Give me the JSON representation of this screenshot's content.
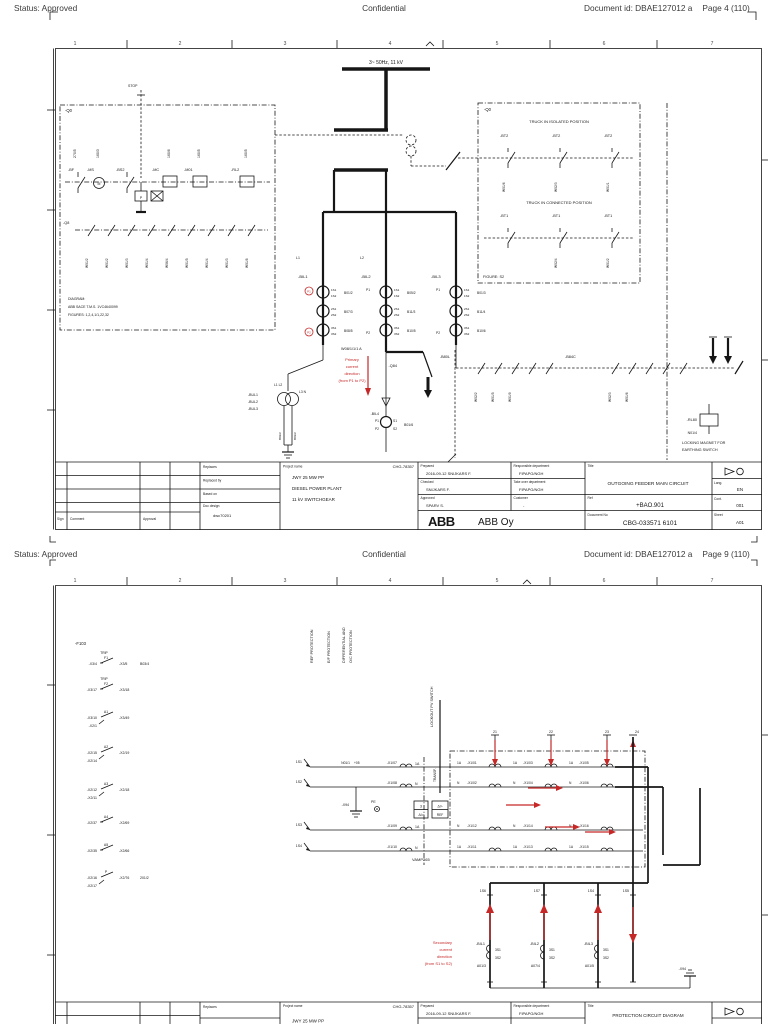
{
  "page1": {
    "header": {
      "status": "Status: Approved",
      "confidential": "Confidential",
      "doc_id": "Document id: DBAE127012 a",
      "page": "Page 4 (110)"
    },
    "ruler": [
      "1",
      "2",
      "3",
      "4",
      "5",
      "6",
      "7"
    ],
    "sch": {
      "stop": "STOP",
      "busbar": "3~ 50Hz,  11 kV",
      "q0l": "-Q0",
      "q0r": "-Q0",
      "wirecols": [
        "270/5",
        "160/3",
        "160/6",
        "160/5",
        "160/5"
      ],
      "bf": "-BF",
      "ms": "-MS",
      "m": "M",
      "bs2": "-BS2",
      "mc": "-MC",
      "m01": "-M01",
      "rl2": "-RL2",
      "p": "P",
      "q8": "-Q8",
      "q8w": [
        "W01/2",
        "W01/2",
        "W01/3",
        "W01/4",
        "W06/4",
        "W01/5",
        "W01/4",
        "W01/3",
        "W01/8"
      ],
      "note1": "DIAGRAM:",
      "note2": "ABB SACE T.M.S. 1VC4640099",
      "note3": "FIGURES: 1,2,4,1/1,22,32",
      "iso": "TRUCK IN ISOLATED POSITION",
      "conn": "TRUCK IN CONNECTED POSITION",
      "bt2": "-BT2",
      "bt1": "-BT1",
      "fig": "FIGURE: S2",
      "isow": [
        "W01/6",
        "W02/3",
        "W01/1"
      ],
      "connw": [
        "W02/4",
        "W01/2"
      ],
      "l1": "L1",
      "l2": "L2",
      "bil": [
        "-BIL1",
        "-BIL2",
        "-BIL3"
      ],
      "ctt": [
        "1S1",
        "1S2",
        "2S1",
        "2S2",
        "3S1",
        "3S2"
      ],
      "ctw": [
        [
          "B01/2",
          "B07/3",
          "B08/5"
        ],
        [
          "B05/2",
          "B11/3",
          "B10/5"
        ],
        [
          "B01/3",
          "B11/4",
          "B10/6"
        ]
      ],
      "p1": "P1",
      "p2": "P2",
      "cable": "W08/1/1/1 A",
      "red": [
        "Primary",
        "current",
        "direction",
        "(from P1 to P2)"
      ],
      "bul": [
        "-BUL1",
        "-BUL2",
        "-BUL3"
      ],
      "vtph": "L1 L2",
      "vtph2": "L3 N",
      "vtw": [
        "B02/2",
        "B03/2"
      ],
      "q84": "-Q84",
      "b80l": "-B80L",
      "b84c": "-B84C",
      "b80lw": [
        "W02/2",
        "W01/5",
        "W01/9"
      ],
      "b84cw": [
        "W02/3",
        "W01/6"
      ],
      "bil4": "-BIL4",
      "bp1": "P1",
      "bp2": "P2",
      "bs1": "S1",
      "bs2t": "S2",
      "bil4w": "B01/6",
      "rl80": "-RL80",
      "rl80w": "N01/4",
      "lock1": "LOCKING MAGNET FOR",
      "lock2": "EARTHING SWITCH"
    },
    "tb": {
      "sign": "Sign",
      "comment": "Comment",
      "approval": "Approval",
      "replaces": "Replaces",
      "replaced_by": "Replaced by",
      "based_on": "Based on",
      "doc_design": "Doc design",
      "doc_design_v": "dwc70201",
      "project_label": "Project name",
      "project_code": "CHG-78357",
      "proj1": "JWY 25 MW PP",
      "proj2": "DIESEL POWER PLANT",
      "proj3": "11 kV SWITCHGEAR",
      "prepared": "Prepared",
      "prepared_v": "2016-09-12 SNIJKARS F.",
      "checked": "Checked",
      "checked_v": "SNIJKARS F.",
      "approved": "Approved",
      "approved_v": "SPARV S.",
      "resp": "Responsible department",
      "resp_v": "FIPAPG/NGH",
      "takeover": "Take over department",
      "takeover_v": "FIPAPG/NGH",
      "customer": "Customer",
      "customer_v": "-",
      "title": "Title",
      "title_v": "OUTGOING FEEDER MAIN CIRCUIT",
      "ref": "Ref",
      "ref_v": "+BAO.901",
      "docno": "Document No",
      "docno_v": "CBG-033571 6101",
      "lang": "Lang.",
      "lang_v": "EN",
      "cont": "Cont.",
      "cont_v": "001",
      "sheet": "Sheet",
      "sheet_v": "A01",
      "abb": "ABB",
      "abb_oy": "ABB Oy"
    }
  },
  "page2": {
    "header": {
      "status": "Status: Approved",
      "confidential": "Confidential",
      "doc_id": "Document id: DBAE127012 a",
      "page": "Page 9 (110)"
    },
    "ruler": [
      "1",
      "2",
      "3",
      "4",
      "5",
      "6",
      "7"
    ],
    "sch": {
      "f103": "-F103",
      "items": [
        {
          "tag": "TRIP",
          "name": "F1",
          "l": "-X3/4",
          "l2": "",
          "r": "-X3/5",
          "w": "B03/4"
        },
        {
          "tag": "TRIP",
          "name": "F2",
          "l": "-X3/17",
          "l2": "",
          "r": "-X3/18",
          "w": ""
        },
        {
          "tag": "",
          "name": "A1",
          "l": "-X3/10",
          "l2": "-X2/1",
          "r": "-X3/49",
          "w": ""
        },
        {
          "tag": "",
          "name": "A2",
          "l": "-X2/15",
          "l2": "-X2/14",
          "r": "-X2/19",
          "w": ""
        },
        {
          "tag": "",
          "name": "A3",
          "l": "-X2/12",
          "l2": "-X2/11",
          "r": "-X2/18",
          "w": ""
        },
        {
          "tag": "",
          "name": "A4",
          "l": "-X2/37",
          "l2": "",
          "r": "-X2/69",
          "w": ""
        },
        {
          "tag": "",
          "name": "A5",
          "l": "-X2/35",
          "l2": "",
          "r": "-X2/66",
          "w": ""
        },
        {
          "tag": "",
          "name": "P",
          "l": "-X2/16",
          "l2": "-X2/17",
          "r": "-X2/76",
          "w": "201/2"
        }
      ],
      "vt1": "REF PROTECTION",
      "vt2": "E/F PROTECTION",
      "vt3": "DIFFERENTIAL AND",
      "vt4": "O/C PROTECTION",
      "lockout": "LOCKOUT PV SWITCH",
      "terms": [
        "1S1",
        "1S2",
        "1S3",
        "1S4"
      ],
      "n01": "N01/1",
      "plus05": "+05",
      "x1l": [
        "-X1/07",
        "-X1/08",
        "-X1/09",
        "-X1/10"
      ],
      "coill": [
        "1A",
        "N",
        "1A",
        "N"
      ],
      "transf": "TRANSF.",
      "x94": "-X94",
      "pe": "PE",
      "rb1a": "3",
      "rb1b": "ΔI>",
      "rb2a": "ΔI>",
      "rb2b": "REF",
      "vamp": "VAMP265",
      "arr": [
        "21",
        "22",
        "23",
        "24"
      ],
      "gt": [
        {
          "a": "1A",
          "t": "-X1/01"
        },
        {
          "a": "1A",
          "t": "-X1/03"
        },
        {
          "a": "1A",
          "t": "-X1/05"
        }
      ],
      "gt2": [
        {
          "a": "N",
          "t": "-X1/02"
        },
        {
          "a": "N",
          "t": "-X1/04"
        },
        {
          "a": "N",
          "t": "-X1/06"
        }
      ],
      "gb": [
        {
          "a": "N",
          "t": "-X1/12"
        },
        {
          "a": "N",
          "t": "-X1/14"
        },
        {
          "a": "N",
          "t": "-X1/16"
        }
      ],
      "gb2": [
        {
          "a": "1A",
          "t": "-X1/11"
        },
        {
          "a": "1A",
          "t": "-X1/13"
        },
        {
          "a": "1A",
          "t": "-X1/15"
        }
      ],
      "ctt": [
        "1S6",
        "1S7",
        "1S4",
        "1S5"
      ],
      "s1": "3S1",
      "s2": "3S2",
      "bilb": [
        {
          "tag": "-BIL1",
          "w": "A01/3"
        },
        {
          "tag": "-BIL2",
          "w": "A07/4"
        },
        {
          "tag": "-BIL3",
          "w": "A01/5"
        }
      ],
      "x94b": "-X94",
      "red": [
        "Secondary",
        "current",
        "direction",
        "(from S1 to S2)"
      ]
    },
    "tb": {
      "replaces": "Replaces",
      "project_label": "Project name",
      "project_code": "CHG-78357",
      "proj1": "JWY 25 MW PP",
      "prepared": "Prepared",
      "prepared_v": "2016-09-12 SNIJKARS F.",
      "resp": "Responsible department",
      "resp_v": "FIPAPG/NGH",
      "title": "Title",
      "title_v": "PROTECTION CIRCUIT DIAGRAM"
    }
  }
}
